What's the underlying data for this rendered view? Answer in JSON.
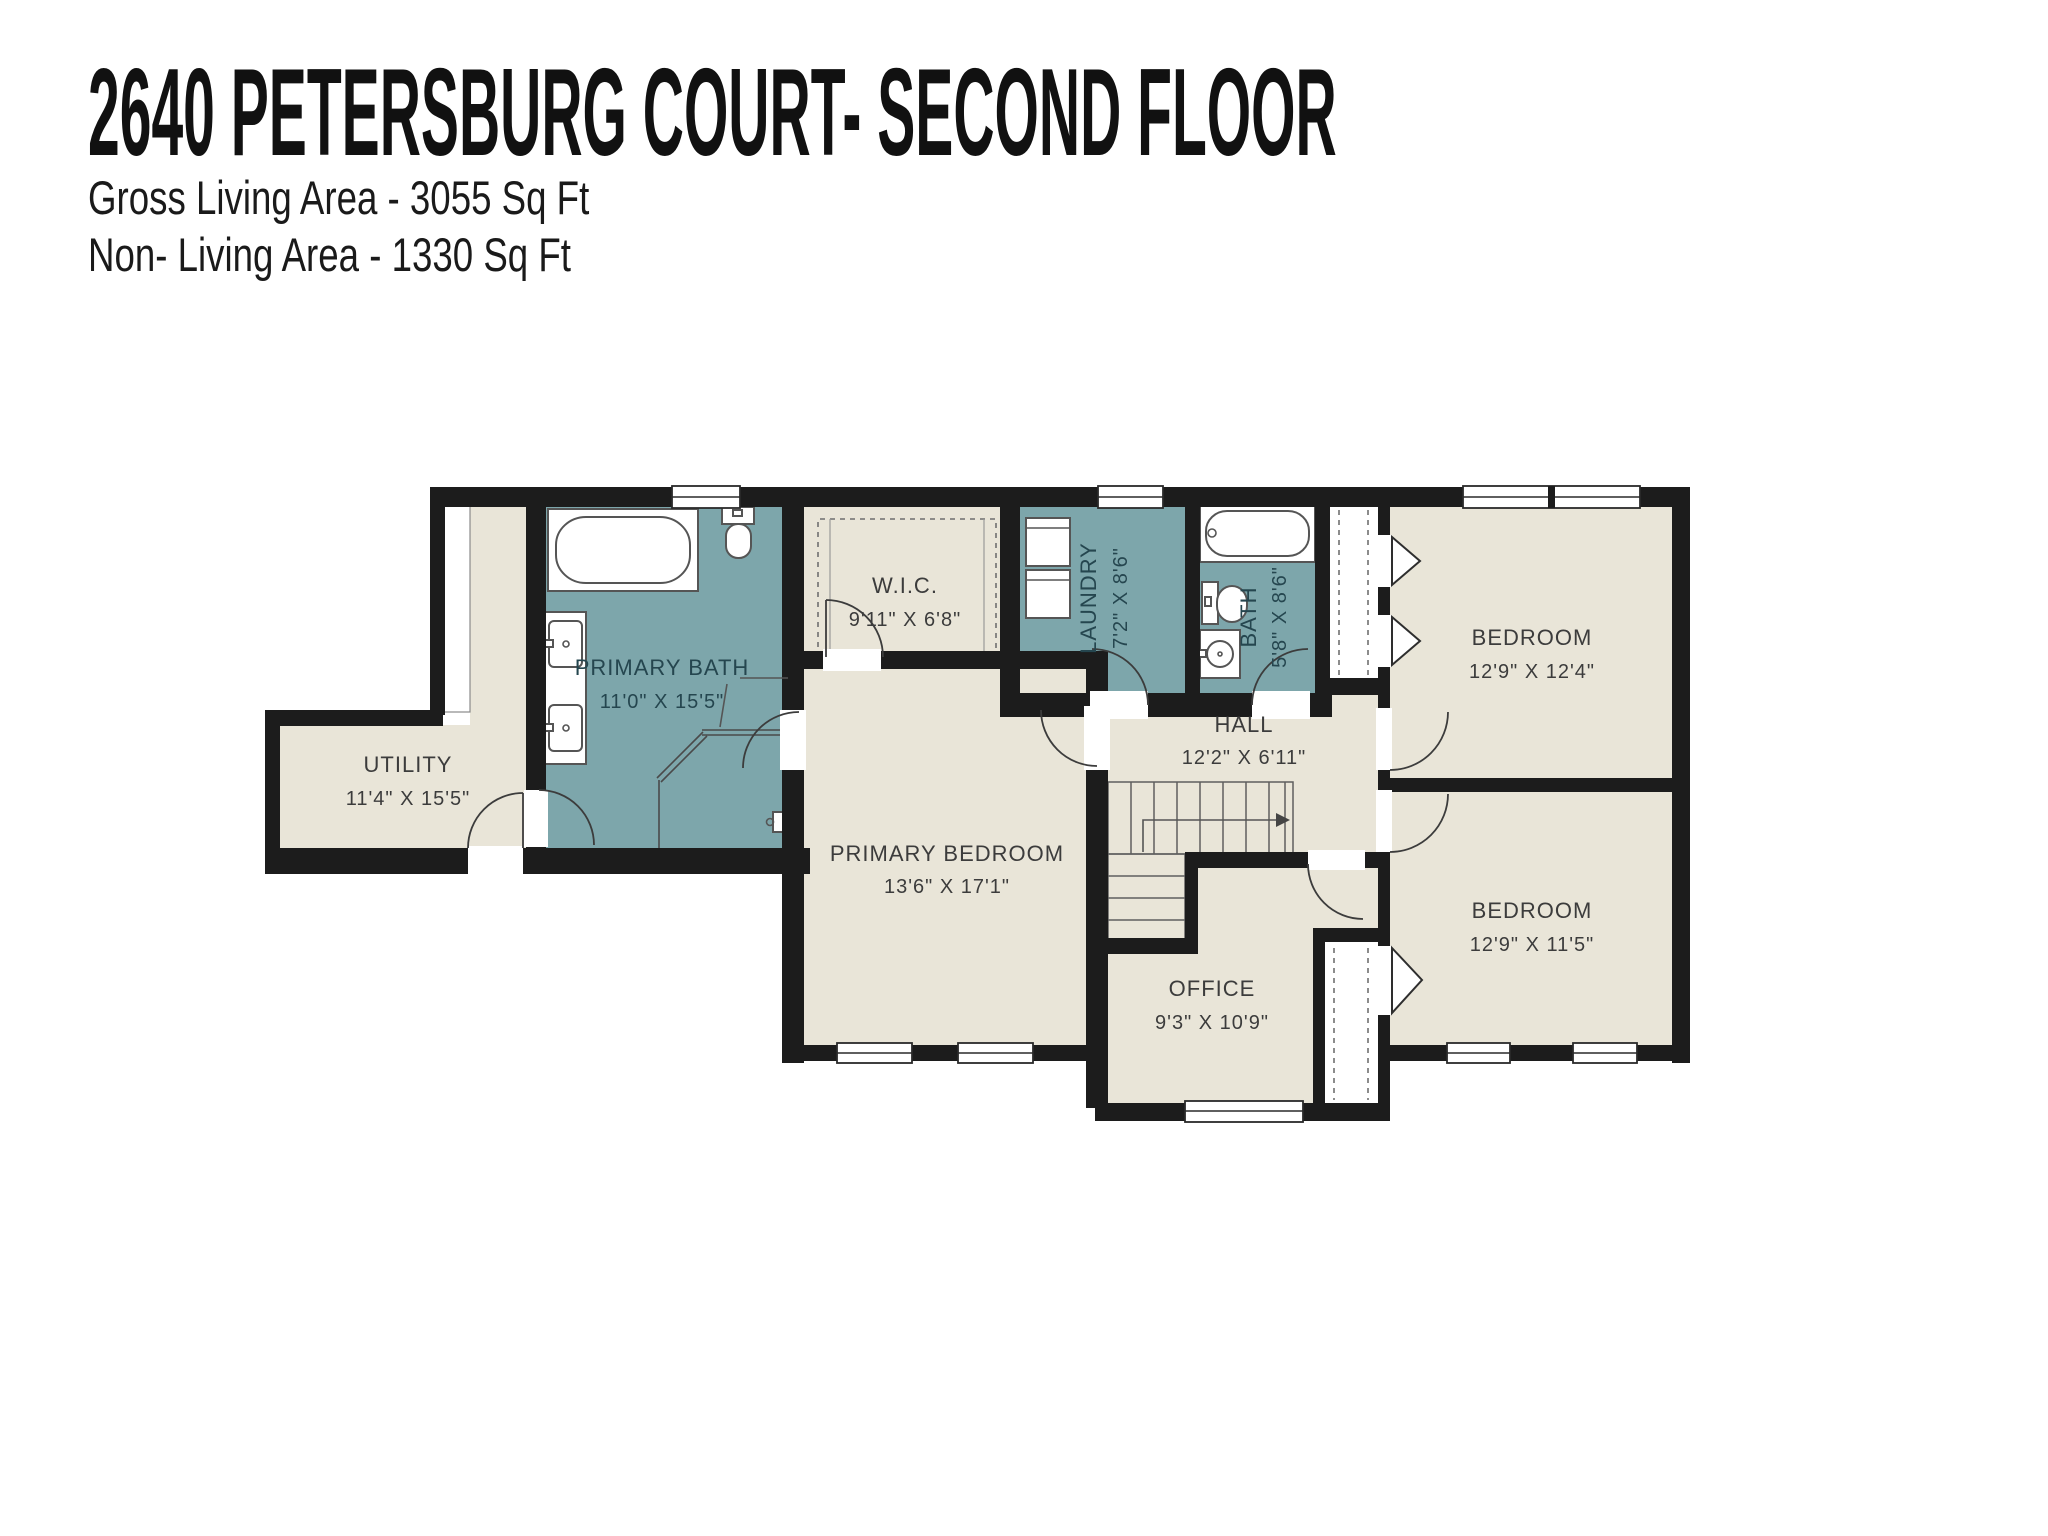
{
  "header": {
    "title": "2640 PETERSBURG COURT- SECOND FLOOR",
    "stats": [
      "Gross Living Area - 3055 Sq Ft",
      "Non- Living Area - 1330 Sq Ft"
    ]
  },
  "rooms": [
    {
      "name": "UTILITY",
      "dims": "11'4\" X 15'5\""
    },
    {
      "name": "PRIMARY BATH",
      "dims": "11'0\" X 15'5\""
    },
    {
      "name": "W.I.C.",
      "dims": "9'11\" X 6'8\""
    },
    {
      "name": "LAUNDRY",
      "dims": "7'2\" X 8'6\""
    },
    {
      "name": "BATH",
      "dims": "5'8\" X 8'6\""
    },
    {
      "name": "BEDROOM",
      "dims": "12'9\" X 12'4\""
    },
    {
      "name": "HALL",
      "dims": "12'2\" X 6'11\""
    },
    {
      "name": "PRIMARY BEDROOM",
      "dims": "13'6\" X 17'1\""
    },
    {
      "name": "OFFICE",
      "dims": "9'3\" X 10'9\""
    },
    {
      "name": "BEDROOM",
      "dims": "12'9\" X 11'5\""
    }
  ],
  "fixtures": [
    "bathtub",
    "toilet",
    "double-sink-vanity",
    "corner-shower",
    "washer-dryer-stack",
    "bathtub",
    "toilet",
    "sink",
    "u-shaped-staircase",
    "bifold-closet-doors"
  ],
  "colors": {
    "floor_beige": "#e9e5d8",
    "floor_teal": "#7da6ab",
    "wall": "#1c1c1c",
    "label_dark": "#3c3c3c",
    "label_teal_room": "#25464f",
    "fixture_stroke": "#555555"
  }
}
